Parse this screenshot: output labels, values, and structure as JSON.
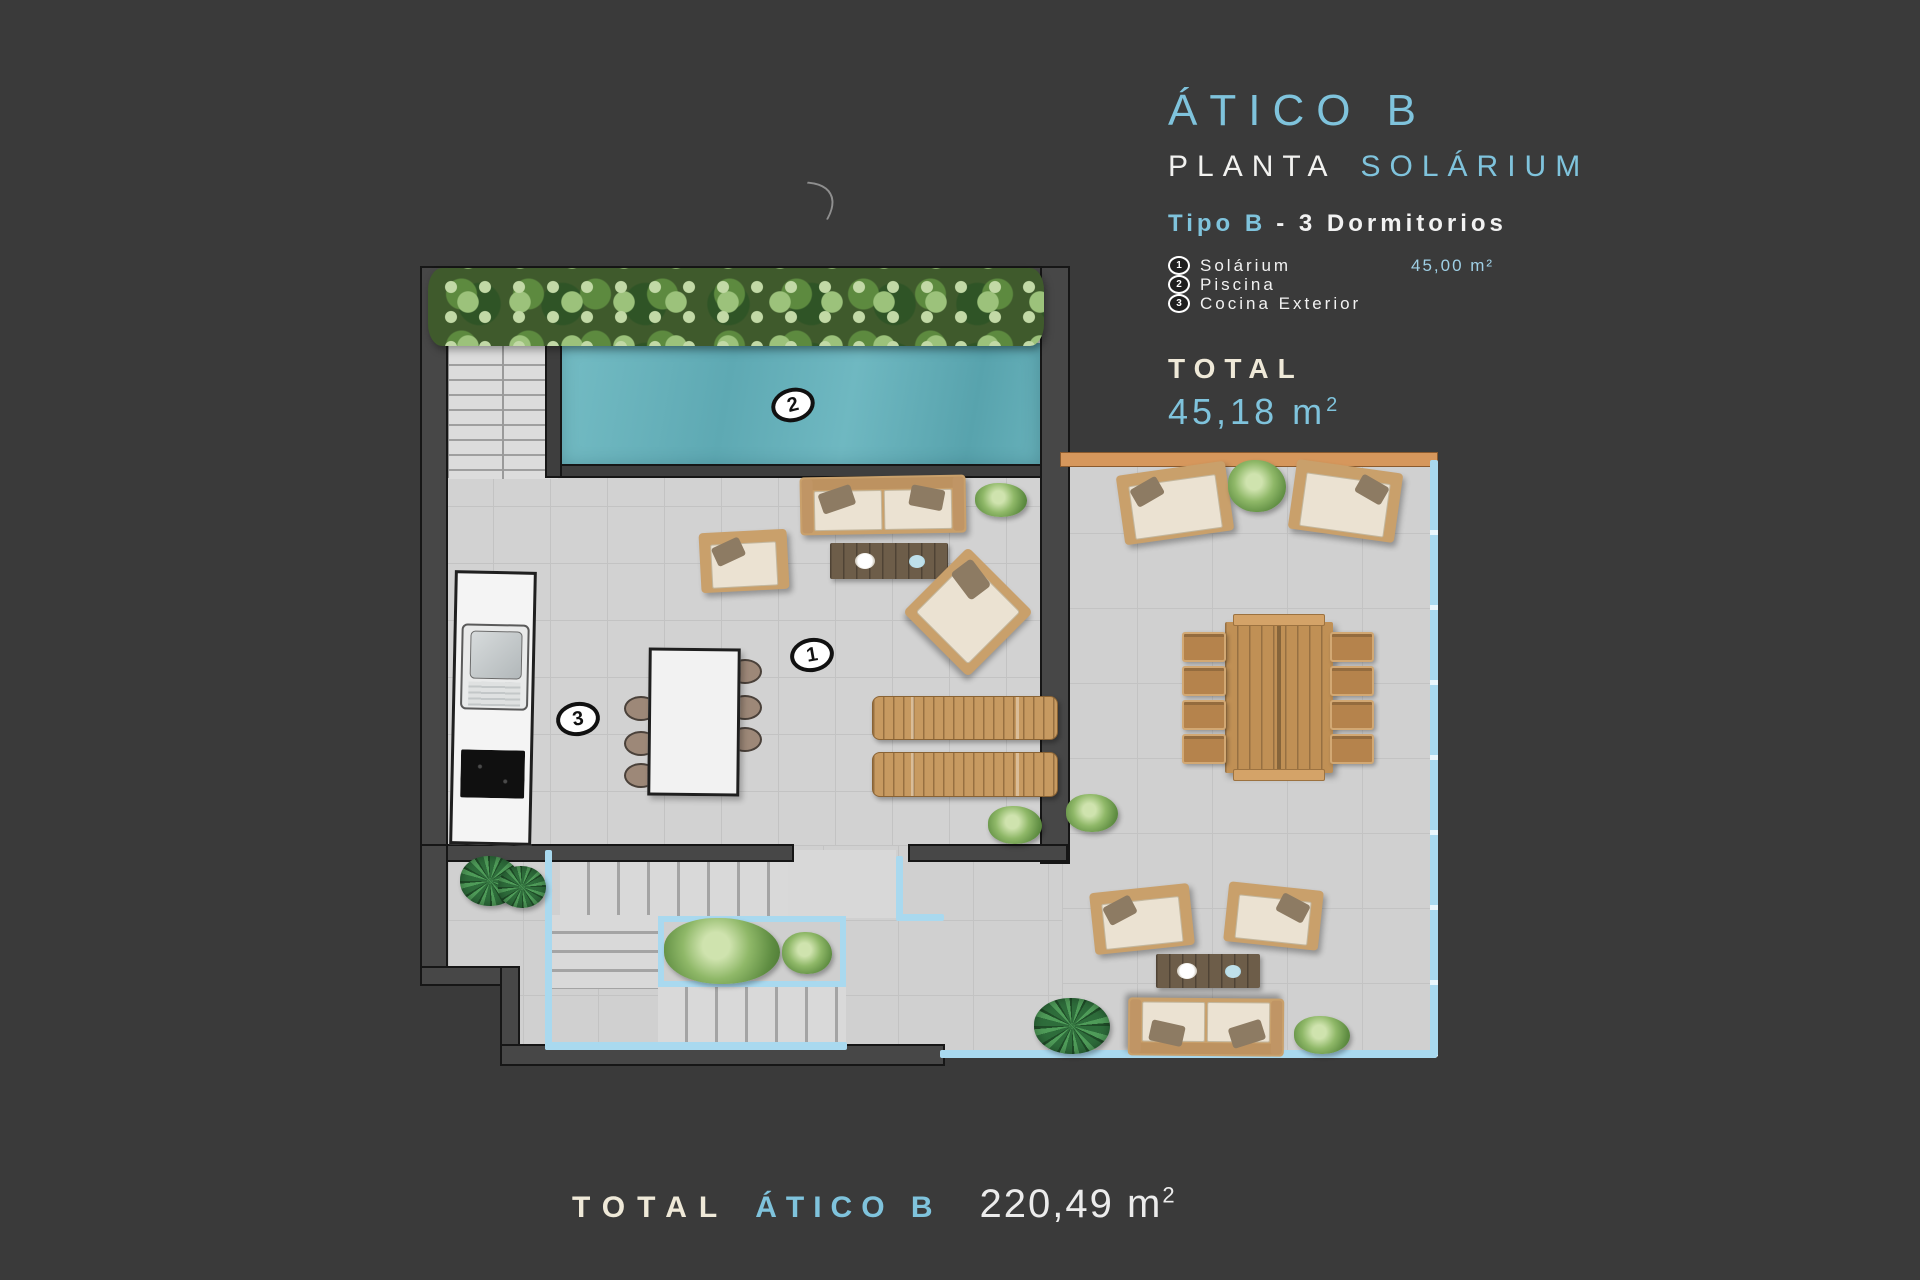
{
  "header": {
    "title": "ÁTICO B",
    "plant_label": "PLANTA",
    "plant_accent": "SOLÁRIUM",
    "type_accent": "Tipo B",
    "type_rest": "- 3  Dormitorios",
    "legend": [
      {
        "num": "1",
        "label": "Solárium",
        "value": "45,00 m²"
      },
      {
        "num": "2",
        "label": "Piscina",
        "value": ""
      },
      {
        "num": "3",
        "label": "Cocina Exterior",
        "value": ""
      }
    ],
    "total_label": "TOTAL",
    "total_value": "45,18",
    "total_unit": "m",
    "total_sup": "2"
  },
  "footer": {
    "label": "TOTAL",
    "name": "ÁTICO B",
    "value": "220,49",
    "unit": "m",
    "sup": "2"
  },
  "plan": {
    "markers": [
      {
        "num": "1"
      },
      {
        "num": "2"
      },
      {
        "num": "3"
      }
    ]
  },
  "colors": {
    "background": "#3a3a3a",
    "accent_blue": "#7fc3dc",
    "cream": "#efe9d8",
    "pool": "#6cb4bd",
    "balustrade": "#a9d9ef",
    "orange_wall": "#d6975c",
    "wood": "#c9995f",
    "floor": "#d2d2d2"
  }
}
